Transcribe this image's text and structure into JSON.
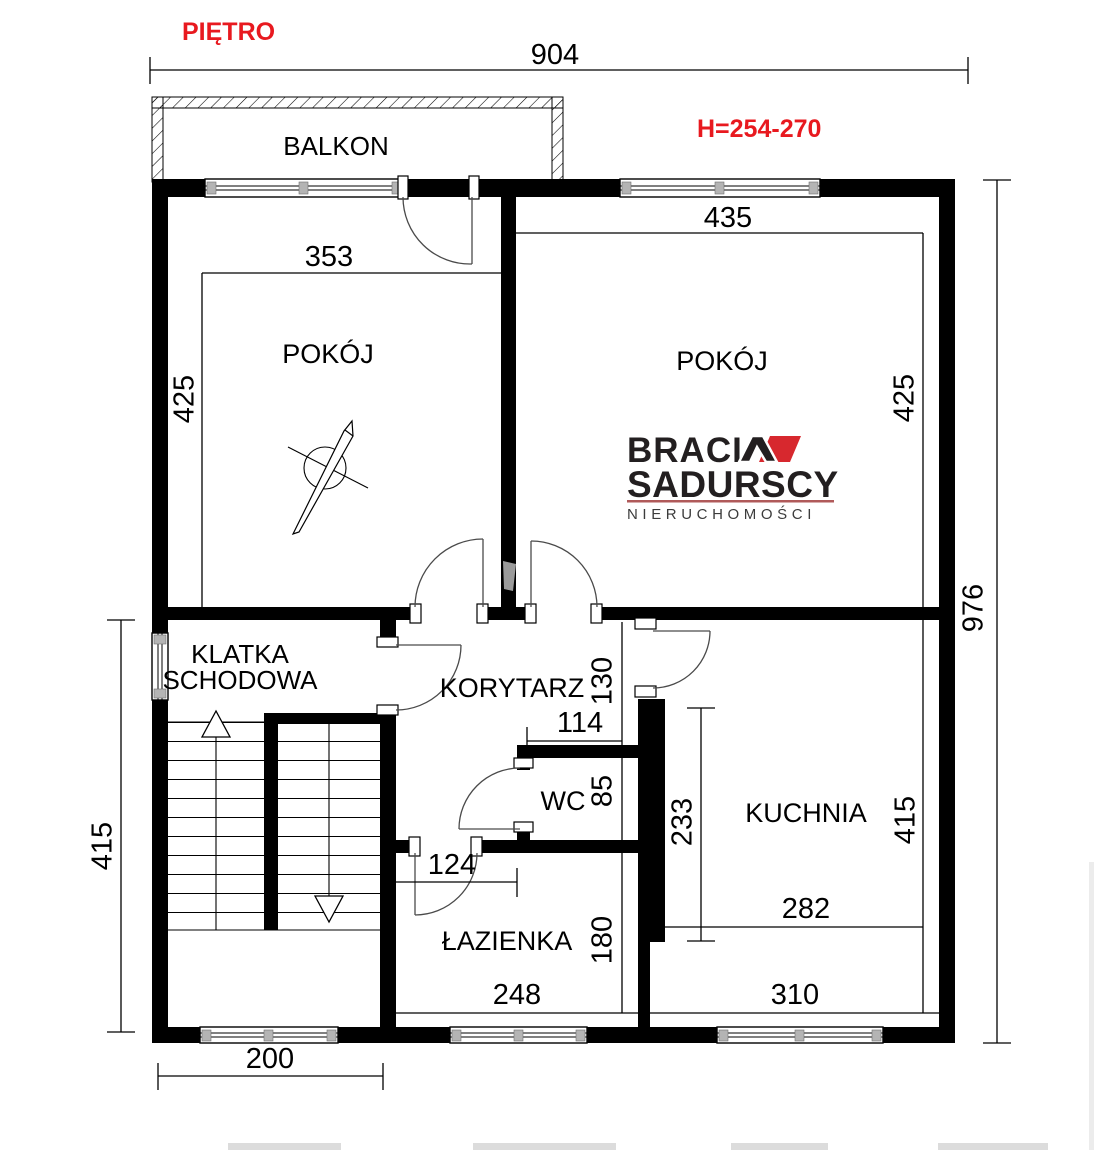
{
  "header": {
    "title": "PIĘTRO",
    "height_note": "H=254-270"
  },
  "rooms": {
    "balcony": "BALKON",
    "room_left": "POKÓJ",
    "room_right": "POKÓJ",
    "staircase_line1": "KLATKA",
    "staircase_line2": "SCHODOWA",
    "corridor": "KORYTARZ",
    "wc": "WC",
    "bathroom": "ŁAZIENKA",
    "kitchen": "KUCHNIA"
  },
  "dimensions": {
    "total_width": "904",
    "total_height": "976",
    "staircase_side_height": "415",
    "staircase_bottom_width": "200",
    "room_left_width": "353",
    "room_left_height": "425",
    "room_right_width": "435",
    "room_right_height": "425",
    "corridor_height": "130",
    "wc_width": "114",
    "wc_height": "85",
    "bathroom_door_width": "124",
    "bathroom_width": "248",
    "bathroom_height": "180",
    "kitchen_wall_segment": "233",
    "kitchen_width_upper": "282",
    "kitchen_width_lower": "310",
    "kitchen_height": "415"
  },
  "logo": {
    "brand_text": "BRACI",
    "brand_mark": "stylized-A-with-red-flag",
    "brand_text2": "SADURSCY",
    "tagline": "NIERUCHOMOŚCI"
  },
  "colors": {
    "wall": "#000000",
    "annotation_red": "#e8191f",
    "logo_red": "#d7282e",
    "logo_dark": "#231f20",
    "logo_underline": "#b05a5a"
  }
}
